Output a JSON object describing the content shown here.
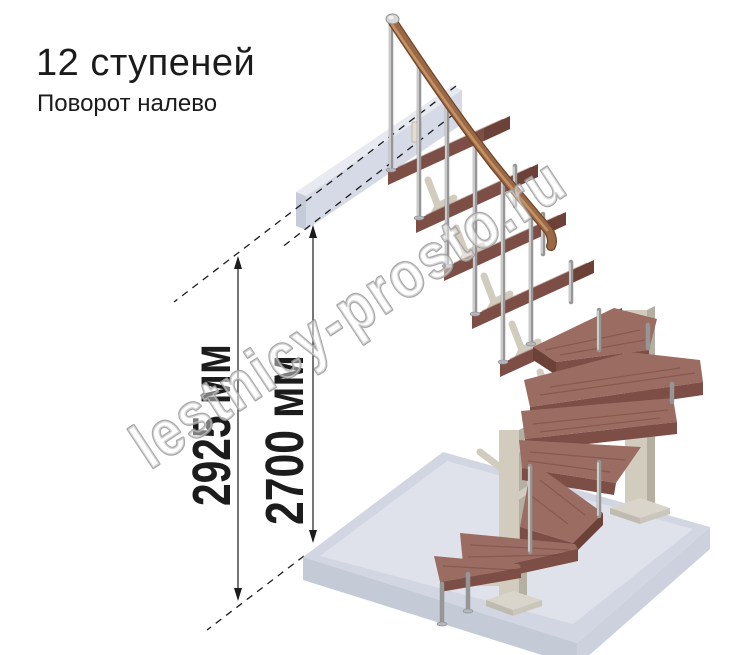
{
  "header": {
    "title": "12 ступеней",
    "subtitle": "Поворот налево"
  },
  "diagram": {
    "dimension_left_label": "2925 мм",
    "dimension_right_label": "2700 мм",
    "watermark": "lestnicy-prosto.ru"
  },
  "colors": {
    "background": "#ffffff",
    "dimension_ink": "#1c1c1c",
    "watermark_outline": "#9b9b9b",
    "step_top": "#9b6c62",
    "step_front": "#7c4e45",
    "step_side": "#6c4138",
    "handrail": "#9a6844",
    "handrail_light": "#c99668",
    "metal": "#969696",
    "metal_light": "#dcdcdc",
    "support": "#d2ccbf",
    "support_shade": "#b5afa2",
    "beam_top": "#e8eaf2",
    "beam_front": "#d6dae6",
    "beam_end": "#c6cbd9",
    "floor_top": "#dfe2eb",
    "floor_edge": "#d2d6e2",
    "floor_front_left": "#c5cad7",
    "floor_front_right": "#ccd1dd"
  }
}
